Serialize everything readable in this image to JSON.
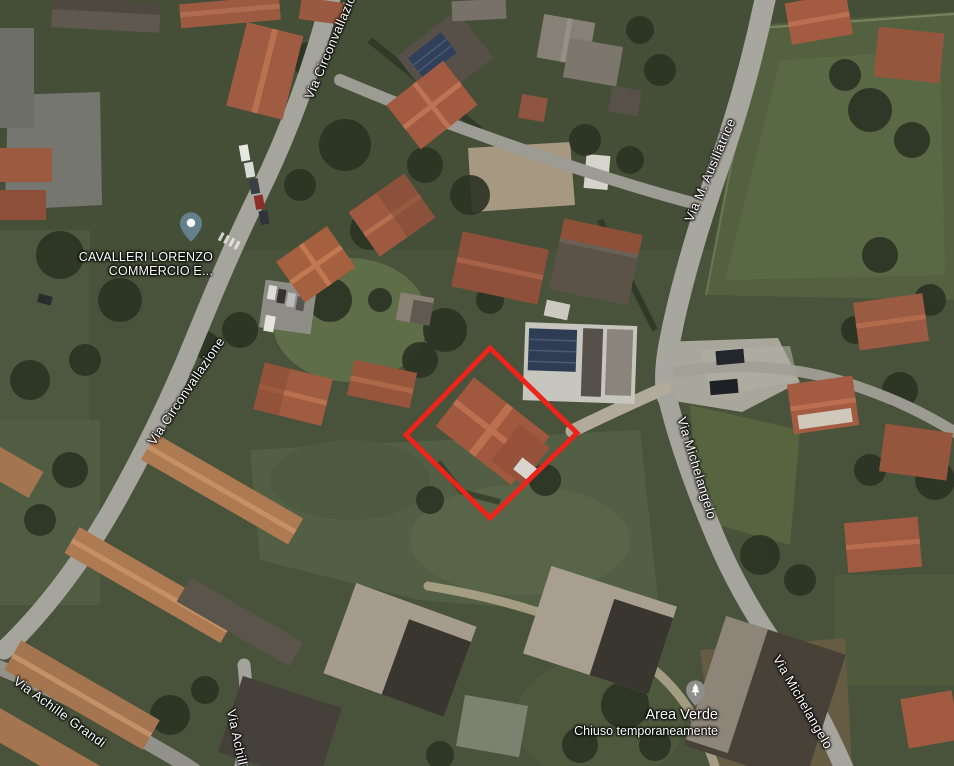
{
  "map": {
    "view_type": "satellite",
    "streets": [
      {
        "label": "Via Circonvallazione"
      },
      {
        "label": "Via Circonvallazione"
      },
      {
        "label": "Via M. Ausiliatrice"
      },
      {
        "label": "Via Michelangelo"
      },
      {
        "label": "Via Michelangelo"
      },
      {
        "label": "Via Achille Grandi"
      },
      {
        "label": "Via Achille"
      }
    ],
    "pois": [
      {
        "name_line1": "CAVALLERI LORENZO",
        "name_line2": "COMMERCIO E...",
        "pin_icon": "generic-poi-pin"
      },
      {
        "name": "Area Verde",
        "status": "Chiuso temporaneamente",
        "pin_icon": "tree-pin"
      }
    ],
    "highlight": {
      "shape": "rotated-square-outline",
      "color": "#ed241c"
    }
  }
}
